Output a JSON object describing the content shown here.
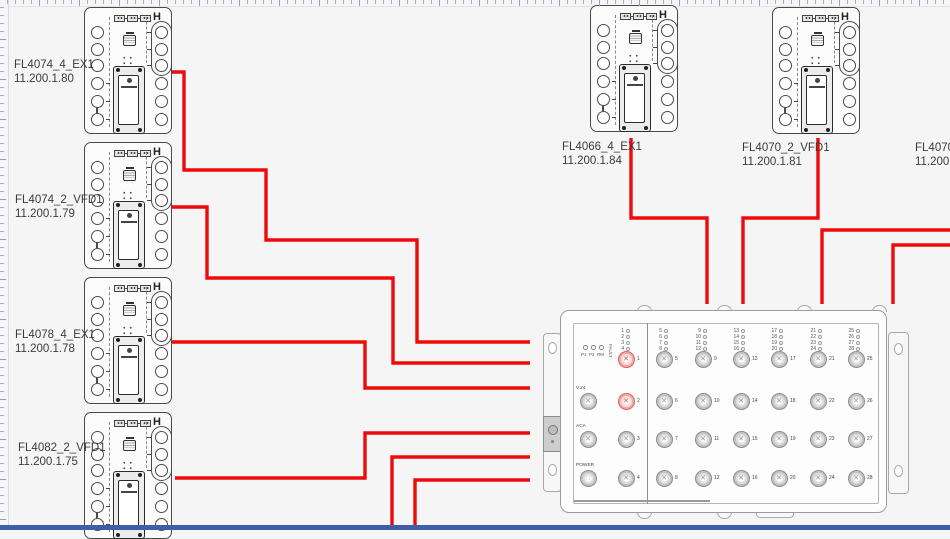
{
  "colors": {
    "canvas_bg": "#f5f5f6",
    "wire_red": "#ee0a0a",
    "bottom_bar": "#3e5fa7",
    "port_red": "#e06262"
  },
  "glyphs": {
    "h_symbol": "H"
  },
  "devices": [
    {
      "label": "FL4074_4_EX1",
      "ip": "11.200.1.80",
      "x": 84,
      "y": 7,
      "label_x": 14,
      "label_y": 58
    },
    {
      "label": "FL4074_2_VFD1",
      "ip": "11.200.1.79",
      "x": 84,
      "y": 142,
      "label_x": 15,
      "label_y": 193
    },
    {
      "label": "FL4078_4_EX1",
      "ip": "11.200.1.78",
      "x": 84,
      "y": 277,
      "label_x": 15,
      "label_y": 328
    },
    {
      "label": "FL4082_2_VFD1",
      "ip": "11.200.1.75",
      "x": 84,
      "y": 412,
      "label_x": 18,
      "label_y": 441
    },
    {
      "label": "FL4066_4_EX1",
      "ip": "11.200.1.84",
      "x": 590,
      "y": 5,
      "label_x": 562,
      "label_y": 140
    },
    {
      "label": "FL4070_2_VFD1",
      "ip": "11.200.1.81",
      "x": 772,
      "y": 7,
      "label_x": 742,
      "label_y": 141
    }
  ],
  "offscreen_device": {
    "label": "FL4070_",
    "ip": "11.200.1",
    "label_x": 915,
    "label_y": 141
  },
  "switch": {
    "status_leds": [
      "P1",
      "P2",
      "RM"
    ],
    "fault_label": "FAULT",
    "special_ports": [
      "V.24",
      "ACA",
      "POWER"
    ],
    "port_columns": [
      [
        1,
        2,
        3,
        4
      ],
      [
        5,
        6,
        7,
        8
      ],
      [
        9,
        10,
        11,
        12
      ],
      [
        13,
        14,
        15,
        16
      ],
      [
        17,
        18,
        19,
        20
      ],
      [
        21,
        22,
        23,
        24
      ],
      [
        25,
        26,
        27,
        28
      ]
    ],
    "red_ports": [
      1,
      2
    ]
  },
  "connections": [
    {
      "name": "FL4074_4_EX1-to-switch",
      "points": [
        [
          172,
          72
        ],
        [
          184,
          72
        ],
        [
          184,
          170
        ],
        [
          266,
          170
        ],
        [
          266,
          240
        ],
        [
          417,
          240
        ],
        [
          417,
          342
        ],
        [
          530,
          342
        ]
      ]
    },
    {
      "name": "FL4074_2_VFD1-to-switch",
      "points": [
        [
          170,
          207
        ],
        [
          207,
          207
        ],
        [
          207,
          278
        ],
        [
          393,
          278
        ],
        [
          393,
          363
        ],
        [
          530,
          363
        ]
      ]
    },
    {
      "name": "FL4078_4_EX1-to-switch",
      "points": [
        [
          172,
          342
        ],
        [
          365,
          342
        ],
        [
          365,
          388
        ],
        [
          530,
          388
        ]
      ]
    },
    {
      "name": "FL4082_2_VFD1-to-switch",
      "points": [
        [
          175,
          478
        ],
        [
          365,
          478
        ],
        [
          365,
          433
        ],
        [
          530,
          433
        ]
      ]
    },
    {
      "name": "bottom-line-1-to-switch",
      "points": [
        [
          392,
          527
        ],
        [
          392,
          457
        ],
        [
          530,
          457
        ]
      ]
    },
    {
      "name": "bottom-line-2-to-switch",
      "points": [
        [
          415,
          527
        ],
        [
          415,
          480
        ],
        [
          530,
          480
        ]
      ]
    },
    {
      "name": "FL4066_4_EX1-to-switch",
      "points": [
        [
          631,
          138
        ],
        [
          631,
          218
        ],
        [
          707,
          218
        ],
        [
          707,
          304
        ]
      ]
    },
    {
      "name": "FL4070_2_VFD1-to-switch",
      "points": [
        [
          818,
          138
        ],
        [
          818,
          218
        ],
        [
          743,
          218
        ],
        [
          743,
          304
        ]
      ]
    },
    {
      "name": "right-line-1-to-switch",
      "points": [
        [
          950,
          230
        ],
        [
          822,
          230
        ],
        [
          822,
          304
        ]
      ]
    },
    {
      "name": "right-line-2-to-switch",
      "points": [
        [
          950,
          245
        ],
        [
          893,
          245
        ],
        [
          893,
          304
        ]
      ]
    }
  ]
}
